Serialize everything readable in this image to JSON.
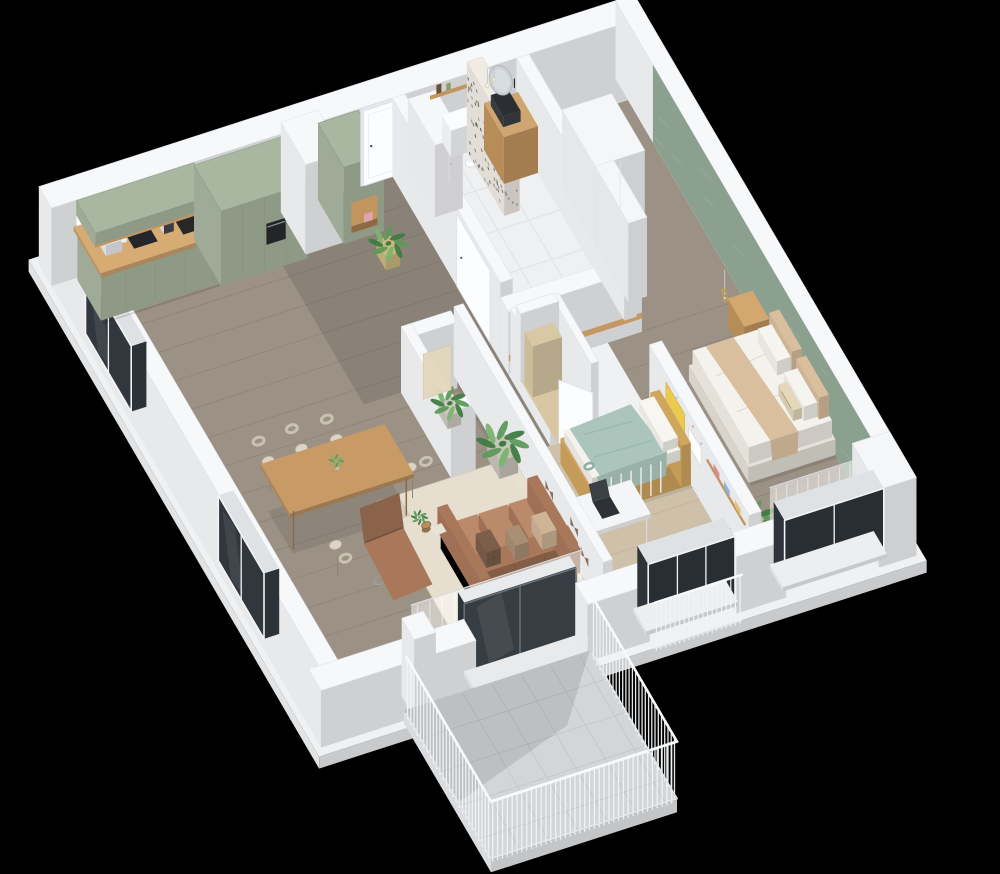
{
  "scene": {
    "view": "isometric-cutaway-apartment",
    "background": "#000000"
  },
  "rooms": [
    {
      "id": "shell",
      "label": "Apartment Shell"
    },
    {
      "id": "kitchen",
      "label": "Kitchen"
    },
    {
      "id": "entry-hall",
      "label": "Entry Hall"
    },
    {
      "id": "bathroom",
      "label": "Bathroom"
    },
    {
      "id": "master-bedroom",
      "label": "Master Bedroom"
    },
    {
      "id": "kids-room",
      "label": "Kids Room"
    },
    {
      "id": "living-dining",
      "label": "Living and Dining Room"
    },
    {
      "id": "closet",
      "label": "Walk-in Closet"
    },
    {
      "id": "storage",
      "label": "Storage Room"
    },
    {
      "id": "balcony",
      "label": "Balcony"
    }
  ],
  "palette": {
    "bg": "#000000",
    "wall": "#f7f8fa",
    "wallEdge": "#e1e4e9",
    "floor": "#9b9185",
    "plank": "#8a8075",
    "kidFloor": "#cfc1a9",
    "kidPlank": "#bfb195",
    "bathFloor": "#eef0f1",
    "grout": "#dde0e3",
    "balconyTile": "#d3d6d9",
    "balconyLine": "#bfc2c6",
    "glass": "#31373d",
    "glassFrame": "#6a7178",
    "winFrame": "#f2f4f6",
    "sage": "#a9b6a0",
    "wood": "#c2955f",
    "woodLight": "#d2a86f",
    "counter": "#caa06b",
    "counterTop": "#d6ab74",
    "black": "#24262a",
    "terrazzo": "#f0ebe4",
    "speck": "#3b3b3d",
    "accentGreen": "#8ba08f",
    "sofa": "#a9775a",
    "sofaLight": "#bb8a6b",
    "rug": "#e9e1d2",
    "tableWood": "#b78f5f",
    "cream": "#dcd5c4",
    "chairRim": "#c9c2b0",
    "mint": "#abc5bd",
    "mintDark": "#93b2a9",
    "bedWhite": "#f1efe8",
    "beige": "#d9bf9e",
    "tanFloor": "#d8c7a2",
    "gold": "#c9a24a",
    "kidWood": "#d0a55e",
    "plant1": "#5d9a58",
    "plant2": "#3f7b42",
    "plant3": "#79b56f",
    "white": "#ffffff",
    "doorLeaf": "#fcfdfe",
    "doorFrame": "#e4e7eb",
    "pink": "#e2a4b0",
    "yellow": "#ecc94f"
  }
}
